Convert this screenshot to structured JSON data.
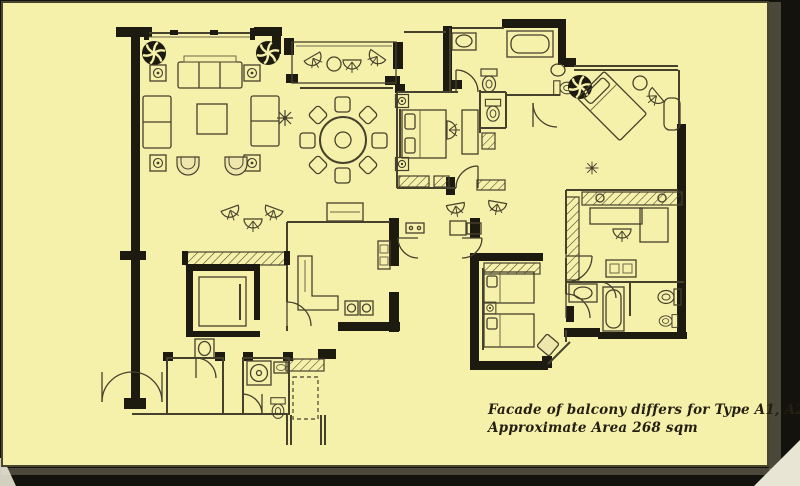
{
  "caption": {
    "line1": "Facade of balcony differs for Type A1, A2, & A3.",
    "line2": "Approximate Area 268 sqm"
  },
  "colors": {
    "paper": "#f6f1aa",
    "backdrop": "#14120c",
    "wall": "#1d1a10",
    "ink": "#46412c",
    "ink_light": "#6e6849",
    "chair_fill": "#efe6ab",
    "shadow_soft": "#8f8a74",
    "curl": "#e8e5d4",
    "caption_ink": "#241f12"
  },
  "icons": {
    "ceiling-fan-icon": "black pinwheel rosette",
    "speaker-box-icon": "square with spiral",
    "planter-icon": "asterisk star",
    "wicker-chair-icon": "fan-back chair",
    "table-lamp-icon": "square with circle",
    "toilet-icon": "oval bowl with tank",
    "sink-icon": "oval basin in counter",
    "bathtub-icon": "rounded tub",
    "washer-icon": "square with drum circle",
    "closet-icon": "diagonal hatch strip",
    "elevator-icon": "thick-walled shaft with car",
    "door-swing-icon": "quarter arc"
  }
}
